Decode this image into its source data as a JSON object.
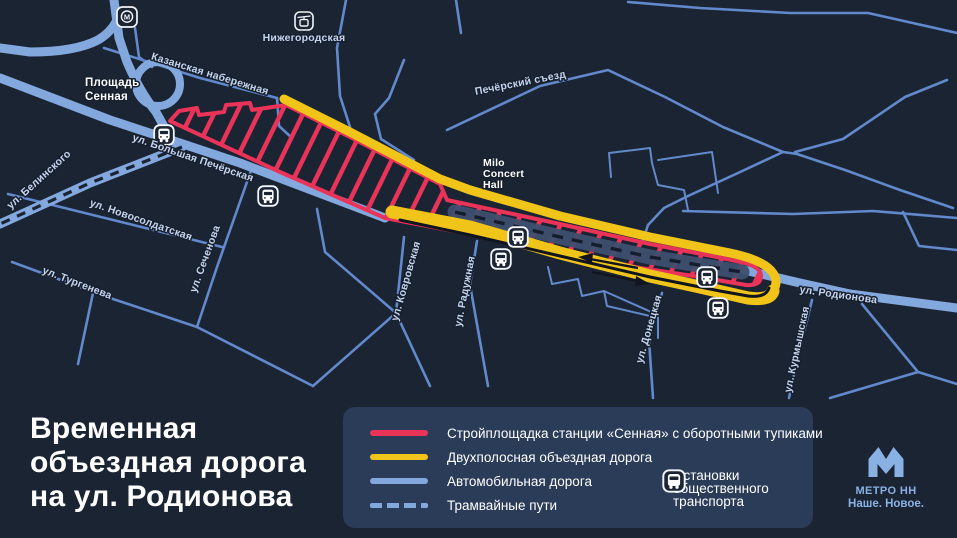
{
  "title": {
    "line1": "Временная",
    "line2": "объездная дорога",
    "line3": "на ул. Родионова"
  },
  "legend": {
    "items": [
      {
        "key": "construction",
        "label": "Стройплощадка станции «Сенная» с оборотными тупиками"
      },
      {
        "key": "bypass",
        "label": "Двухполосная объездная дорога"
      },
      {
        "key": "car-road",
        "label": "Автомобильная дорога"
      },
      {
        "key": "tram",
        "label": "Трамвайные пути"
      }
    ],
    "stops": {
      "line1": "Остановки",
      "line2": "общественного",
      "line3": "транспорта"
    }
  },
  "branding": {
    "name": "МЕТРО НН",
    "tagline": "Наше. Новое."
  },
  "map": {
    "streets": {
      "belinskogo": "ул. Белинского",
      "kazanskaya": "Казанская набережная",
      "bolshaya_pecherskaya": "ул. Большая Печёрская",
      "novosoldatskaya": "ул. Новосолдатская",
      "sechenova": "ул. Сеченова",
      "turgeneva": "ул. Тургенева",
      "pecherskiy_sezd": "Печёрский съезд",
      "kovrovskaya": "ул. Ковровская",
      "raduzhnaya": "ул. Радужная",
      "donetskaya": "ул. Донецкая",
      "kurmyshskaya": "ул. Курмышская",
      "rodionova": "ул. Родионова"
    },
    "places": {
      "sennaya1": "Площадь",
      "sennaya2": "Сенная",
      "nizhegorodskaya": "Нижегородская",
      "milo1": "Milo",
      "milo2": "Concert",
      "milo3": "Hall"
    },
    "icons": {
      "metro_m": "М"
    }
  },
  "colors": {
    "background": "#1b2433",
    "panel": "#2b3c58",
    "construction_red": "#ea3358",
    "bypass_yellow": "#f0c418",
    "road_blue": "#83a8de",
    "road_minor_blue": "#6189cc",
    "closed_road_gray": "#3e5070",
    "label_blue": "#c6d5ee",
    "brand_blue": "#8ab1e4",
    "lane_black": "#10151f",
    "text_white": "#ffffff"
  }
}
